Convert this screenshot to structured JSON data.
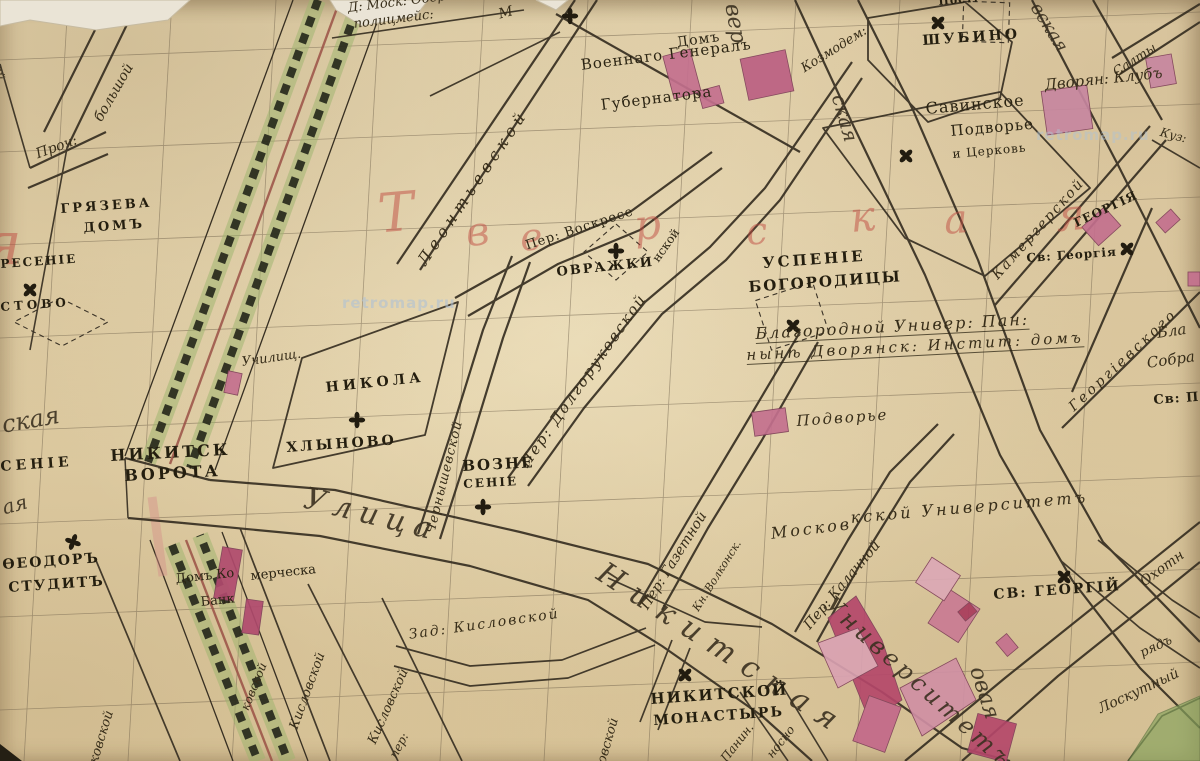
{
  "map": {
    "watermark": {
      "text": "retromap.ru"
    },
    "district": {
      "letters": [
        "Т",
        "в",
        "е",
        "р",
        "с",
        "к",
        "а",
        "я"
      ],
      "partial_letter": "я",
      "color": "#bf4b42"
    },
    "colors": {
      "paper": "#e5d4ab",
      "ink": "#2b2413",
      "building_pink": "#c4708e",
      "building_crimson": "#b04a6e",
      "boulevard_green": "#9cb46b",
      "district_red": "#bf4b42",
      "road_tint": "#d4908a",
      "watermark_blue": "#b0c1d3",
      "green_area": "#88a45e"
    },
    "icons": {
      "church_cross": "four-petal-cross"
    },
    "labels": [
      {
        "name": "ober-politsmeister-line1",
        "text": "Д: Моск: Обер-"
      },
      {
        "name": "ober-politsmeister-line2",
        "text": "полицмейс:"
      },
      {
        "name": "house-mark-m",
        "text": "М"
      },
      {
        "name": "governor-general-house-1",
        "text": "Домъ"
      },
      {
        "name": "governor-general-house-2",
        "text": "Военнаго Генералъ"
      },
      {
        "name": "governor-general-house-3",
        "text": "Губернатора"
      },
      {
        "name": "church-shubino",
        "text": "ШУБИНО"
      },
      {
        "name": "post-fragment",
        "text": "Пост:"
      },
      {
        "name": "street-kozmodem",
        "text": "Козмодем:"
      },
      {
        "name": "savinskoe-1",
        "text": "Савинское"
      },
      {
        "name": "savinskoe-2",
        "text": "Подворье"
      },
      {
        "name": "savinskoe-3",
        "text": "и Церковь"
      },
      {
        "name": "nobles-club",
        "text": "Дворян: Клубъ"
      },
      {
        "name": "street-salty-fragment",
        "text": "Салты"
      },
      {
        "name": "street-kuz-fragment",
        "text": "Куз:"
      },
      {
        "name": "street-tverskaya-frag1",
        "text": "вер"
      },
      {
        "name": "street-tverskaya-frag2",
        "text": "ская"
      },
      {
        "name": "street-dmitrovka-frag",
        "text": "вская"
      },
      {
        "name": "lane-kamergersky",
        "text": "Камергерской"
      },
      {
        "name": "church-uspenie-1",
        "text": "УСПЕНІЕ"
      },
      {
        "name": "church-uspenie-2",
        "text": "БОГОРОДИЦЫ"
      },
      {
        "name": "ovrazhki",
        "text": "ОВРАЖКИ"
      },
      {
        "name": "lane-voskresensky",
        "text": "Пер: Воскресе"
      },
      {
        "name": "lane-voskresensky-cont",
        "text": "нской"
      },
      {
        "name": "lane-dolgorukovsky",
        "text": "Пер: Долгоруковской"
      },
      {
        "name": "lane-chernyshevsky",
        "text": "Чернышевской"
      },
      {
        "name": "church-nikola",
        "text": "НИКОЛА"
      },
      {
        "name": "khlynovo",
        "text": "ХЛЫНОВО"
      },
      {
        "name": "school",
        "text": "Училищ."
      },
      {
        "name": "church-voznesenie-1",
        "text": "ВОЗНЕ"
      },
      {
        "name": "church-voznesenie-2",
        "text": "СЕНІЕ"
      },
      {
        "name": "ulitsa-cursive",
        "text": "Улица"
      },
      {
        "name": "nikitsk-gates-1",
        "text": "НИКИТСК"
      },
      {
        "name": "nikitsk-gates-2",
        "text": "ВОРОТА"
      },
      {
        "name": "church-resenie-frag",
        "text": "РЕСЕНІЕ"
      },
      {
        "name": "stovo-frag",
        "text": "СТОВО"
      },
      {
        "name": "street-skaya-frag",
        "text": "ская"
      },
      {
        "name": "senie-frag",
        "text": "СЕНІЕ"
      },
      {
        "name": "aya-frag",
        "text": "ая"
      },
      {
        "name": "church-feodor-1",
        "text": "ѲЕОДОРЪ"
      },
      {
        "name": "church-feodor-2",
        "text": "СТУДИТЪ"
      },
      {
        "name": "gryazeva-house-1",
        "text": "ГРЯЗЕВА"
      },
      {
        "name": "gryazeva-house-2",
        "text": "ДОМЪ"
      },
      {
        "name": "proch",
        "text": "Проч:"
      },
      {
        "name": "street-bolshoy-frag",
        "text": "большой"
      },
      {
        "name": "street-noy-frag",
        "text": "ной"
      },
      {
        "name": "street-leontievsky",
        "text": "Леонтьевской"
      },
      {
        "name": "commercial-bank-1",
        "text": "Домъ Ко"
      },
      {
        "name": "commercial-bank-2",
        "text": "мерческа"
      },
      {
        "name": "commercial-bank-3",
        "text": "Банк"
      },
      {
        "name": "lane-zad-kislovsky",
        "text": "Зад: Кисловской"
      },
      {
        "name": "lane-kislovsky-frag-a",
        "text": "ковской"
      },
      {
        "name": "lane-kislovsky-frag-b",
        "text": "ковской"
      },
      {
        "name": "lane-kislovsky-frag-c",
        "text": "Кисловской"
      },
      {
        "name": "lane-kislovsky-frag-d",
        "text": "Кисловской"
      },
      {
        "name": "nikitskaya-street-cursive",
        "text": "Никитская"
      },
      {
        "name": "lane-gazetny",
        "text": "Пер: Газетной"
      },
      {
        "name": "prince-volkonsky-house",
        "text": "Кн. Волконск."
      },
      {
        "name": "lane-kalachny",
        "text": "Пер: Калачной"
      },
      {
        "name": "moscow-university-1",
        "text": "Москов"
      },
      {
        "name": "moscow-university-2",
        "text": "кской Университетъ"
      },
      {
        "name": "church-st-georgiy",
        "text": "СВ: ГЕОРГІЙ"
      },
      {
        "name": "church-st-georgiya",
        "text": "Св: Георгія"
      },
      {
        "name": "georgiya-rotated",
        "text": "ГЕОРГІЯ"
      },
      {
        "name": "lane-georgievsky",
        "text": "Георгіевского"
      },
      {
        "name": "bla-frag",
        "text": "Бла"
      },
      {
        "name": "sobra-frag",
        "text": "Собра"
      },
      {
        "name": "sv-p-frag",
        "text": "Св: П"
      },
      {
        "name": "noble-pension-line1",
        "text": "Благородной Универ: Пан:"
      },
      {
        "name": "noble-pension-line2",
        "text": "нынѣ Дворянск: Инстит: домъ"
      },
      {
        "name": "podvorye",
        "text": "Подворье"
      },
      {
        "name": "nikitsky-monastery-1",
        "text": "НИКИТСКОЙ"
      },
      {
        "name": "nikitsky-monastery-2",
        "text": "МОНАСТЫРЬ"
      },
      {
        "name": "university-cursive",
        "text": "Университетъ"
      },
      {
        "name": "mokhovaya-frag",
        "text": "овая"
      },
      {
        "name": "okhotny-frag",
        "text": "Охотн"
      },
      {
        "name": "loskutny-ryad-1",
        "text": "Лоскутный"
      },
      {
        "name": "loskutny-ryad-2",
        "text": "рядъ"
      },
      {
        "name": "panin-frag",
        "text": "Панин."
      },
      {
        "name": "nosno-frag",
        "text": "носно"
      },
      {
        "name": "ovskoy-frag",
        "text": "овской"
      },
      {
        "name": "per-frag",
        "text": "пер:"
      }
    ]
  }
}
